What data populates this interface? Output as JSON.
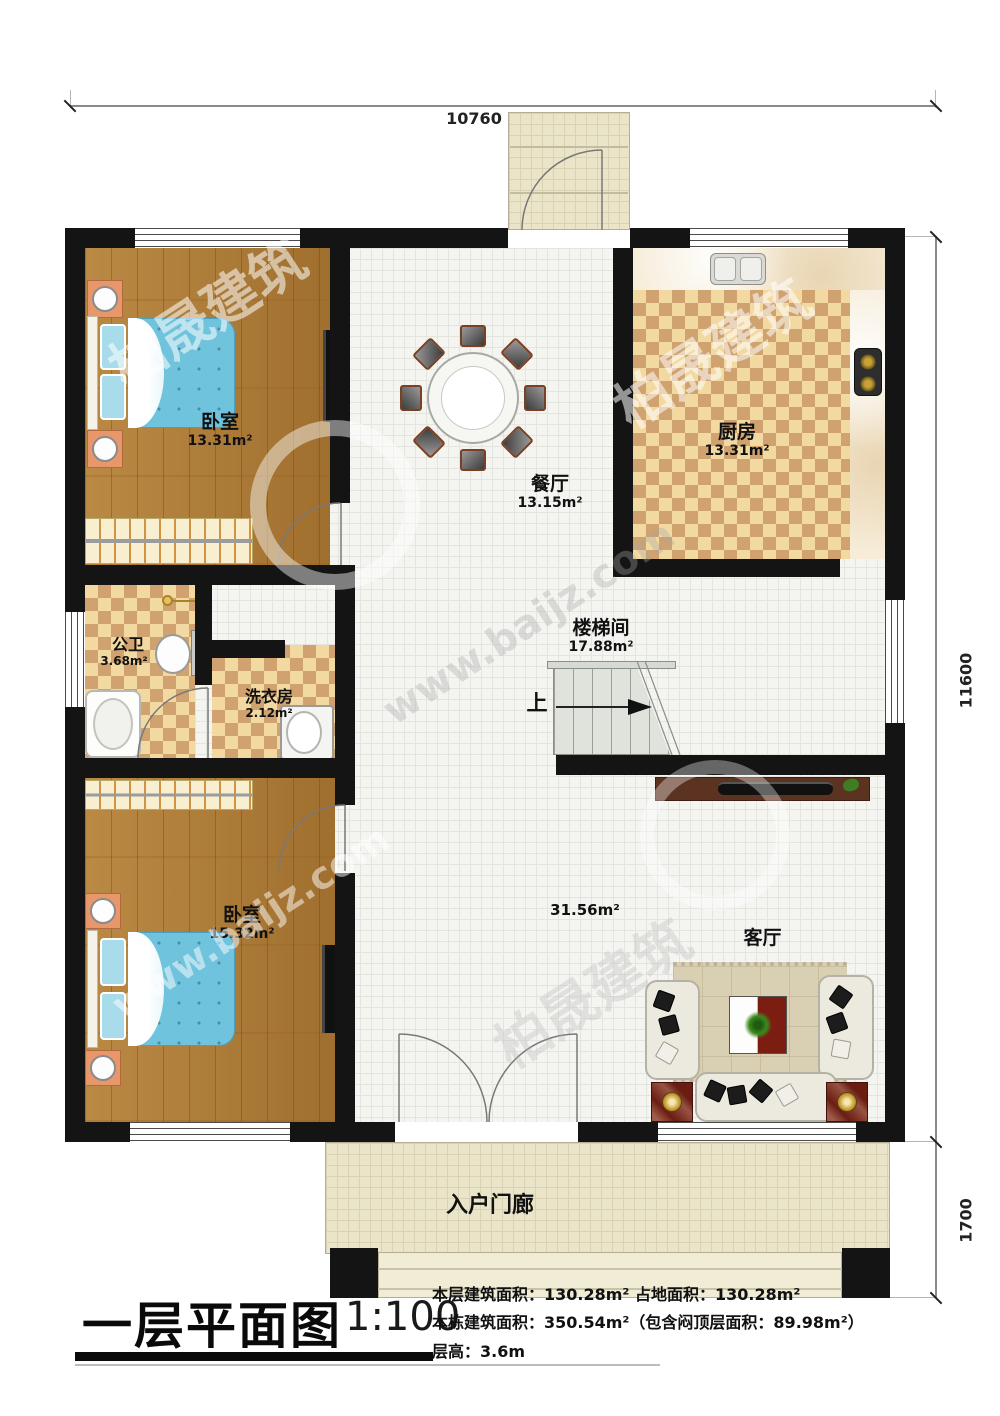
{
  "plan": {
    "dimensions": {
      "width_top": "10760",
      "height_right": "11600",
      "porch_depth_right": "1700"
    },
    "rooms": {
      "bedroom_top": {
        "name": "卧室",
        "area": "13.31m²"
      },
      "dining": {
        "name": "餐厅",
        "area": "13.15m²"
      },
      "kitchen": {
        "name": "厨房",
        "area": "13.31m²"
      },
      "bathroom": {
        "name": "公卫",
        "area": "3.68m²"
      },
      "laundry": {
        "name": "洗衣房",
        "area": "2.12m²"
      },
      "stairwell": {
        "name": "楼梯间",
        "area": "17.88m²"
      },
      "bedroom_bottom": {
        "name": "卧室",
        "area": "15.32m²"
      },
      "living": {
        "name": "客厅",
        "area": "31.56m²"
      },
      "entry_porch": {
        "name": "入户门廊"
      }
    },
    "stairs": {
      "direction_label": "上"
    }
  },
  "title_block": {
    "title": "一层平面图",
    "scale": "1:100",
    "info_lines": [
      "本层建筑面积：130.28m²  占地面积：130.28m²",
      "本栋建筑面积：350.54m²（包含闷顶层面积：89.98m²）",
      "层高：3.6m"
    ]
  },
  "watermark": {
    "brand": "柏晟建筑",
    "url": "www.baijz.com"
  },
  "colors": {
    "wall": "#141414",
    "wood_floor": "#ad7a35",
    "checker_light": "#f2d9a2",
    "checker_dark": "#cfa26f",
    "tile": "#f4f4f1",
    "porch_tile": "#eae5c9",
    "bed": "#72c3dc",
    "stair": "#dfe3dc"
  }
}
